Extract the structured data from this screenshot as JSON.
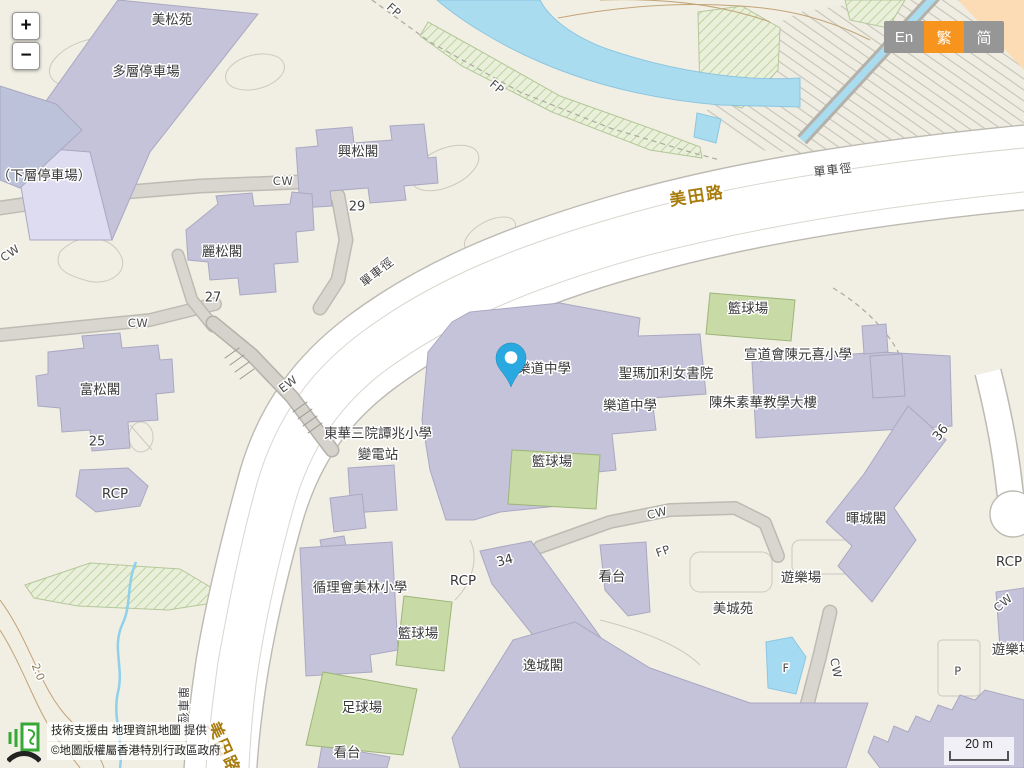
{
  "ui": {
    "zoom_control": {
      "zoom_in": "+",
      "zoom_out": "−"
    },
    "language_switcher": {
      "options": [
        {
          "label": "En",
          "active": false
        },
        {
          "label": "繁",
          "active": true
        },
        {
          "label": "简",
          "active": false
        }
      ]
    },
    "attribution": {
      "logo": "geoinfo-map-logo",
      "support_text": "技術支援由 地理資訊地圖 提供",
      "copyright_text": "©地圖版權屬香港特別行政區政府"
    },
    "scale_bar": "20 m"
  },
  "colors": {
    "background": "#f1efe3",
    "building": "#c5c3d9",
    "building_light": "#dedcf0",
    "road_fill": "#ffffff",
    "road_casing": "#bcbab2",
    "footpath": "#d8d6cf",
    "green_court": "#c8daa6",
    "green_area": "#e9efd9",
    "water": "#aadcf0",
    "contour": "#c2a377",
    "road_label": "#a87d0e",
    "active_lang": "#f7941d",
    "inactive_lang": "#969696",
    "marker": "#2aa9e0",
    "slope_corner": "#fbdcb4"
  },
  "map": {
    "marker": {
      "name": "location-pin",
      "color": "#2aa9e0"
    },
    "labels": [
      {
        "t": "美松苑",
        "x": 172,
        "y": 20,
        "r": 0,
        "c": "b",
        "n": "label-mei-chung-court"
      },
      {
        "t": "多層停車場",
        "x": 146,
        "y": 72,
        "r": 0,
        "c": "b",
        "n": "label-multi-storey-carpark"
      },
      {
        "t": "（下層停車場）",
        "x": 44,
        "y": 176,
        "r": 0,
        "c": "b",
        "n": "label-lower-carpark"
      },
      {
        "t": "興松閣",
        "x": 358,
        "y": 152,
        "r": 0,
        "c": "b",
        "n": "label-hing-chung-house"
      },
      {
        "t": "29",
        "x": 357,
        "y": 207,
        "r": 0,
        "c": "n",
        "n": "label-number-29"
      },
      {
        "t": "麗松閣",
        "x": 222,
        "y": 252,
        "r": 0,
        "c": "b",
        "n": "label-lai-chung-house"
      },
      {
        "t": "27",
        "x": 213,
        "y": 298,
        "r": 0,
        "c": "n",
        "n": "label-number-27"
      },
      {
        "t": "富松閣",
        "x": 100,
        "y": 390,
        "r": 0,
        "c": "b",
        "n": "label-fu-chung-house"
      },
      {
        "t": "25",
        "x": 97,
        "y": 442,
        "r": 0,
        "c": "n",
        "n": "label-number-25"
      },
      {
        "t": "RCP",
        "x": 115,
        "y": 494,
        "r": 0,
        "c": "b",
        "n": "label-rcp-west"
      },
      {
        "t": "CW",
        "x": 283,
        "y": 181,
        "r": 0,
        "c": "p",
        "n": "label-cw-1"
      },
      {
        "t": "CW",
        "x": 138,
        "y": 323,
        "r": 0,
        "c": "p",
        "n": "label-cw-2"
      },
      {
        "t": "CW",
        "x": 10,
        "y": 253,
        "r": -35,
        "c": "p",
        "n": "label-cw-3"
      },
      {
        "t": "EW",
        "x": 288,
        "y": 384,
        "r": -37,
        "c": "p",
        "n": "label-ew"
      },
      {
        "t": "單車徑",
        "x": 377,
        "y": 272,
        "r": -38,
        "c": "cyc",
        "n": "label-cycle-track-1"
      },
      {
        "t": "單車徑",
        "x": 833,
        "y": 170,
        "r": -7,
        "c": "cyc",
        "n": "label-cycle-track-2"
      },
      {
        "t": "單車徑",
        "x": 183,
        "y": 706,
        "r": 90,
        "c": "cyc",
        "n": "label-cycle-track-3"
      },
      {
        "t": "美田路",
        "x": 697,
        "y": 196,
        "r": -9,
        "c": "road",
        "n": "label-mei-tin-road-1"
      },
      {
        "t": "美田路",
        "x": 224,
        "y": 748,
        "r": 66,
        "c": "road",
        "n": "label-mei-tin-road-2"
      },
      {
        "t": "FP",
        "x": 394,
        "y": 10,
        "r": 42,
        "c": "p",
        "n": "label-fp-1"
      },
      {
        "t": "FP",
        "x": 497,
        "y": 87,
        "r": 40,
        "c": "p",
        "n": "label-fp-2"
      },
      {
        "t": "FP",
        "x": 663,
        "y": 551,
        "r": -20,
        "c": "p",
        "n": "label-fp-3"
      },
      {
        "t": "樂道中學",
        "x": 544,
        "y": 369,
        "r": 0,
        "c": "b",
        "n": "label-lok-to-college-1"
      },
      {
        "t": "聖瑪加利女書院",
        "x": 666,
        "y": 374,
        "r": 0,
        "c": "b",
        "n": "label-st-margaret-college"
      },
      {
        "t": "樂道中學",
        "x": 630,
        "y": 406,
        "r": 0,
        "c": "b",
        "n": "label-lok-to-college-2"
      },
      {
        "t": "陳朱素華教學大樓",
        "x": 763,
        "y": 403,
        "r": 0,
        "c": "b",
        "n": "label-chan-chu-so-wah-building"
      },
      {
        "t": "宣道會陳元喜小學",
        "x": 798,
        "y": 355,
        "r": 0,
        "c": "b",
        "n": "label-chan-yuen-hei-primary"
      },
      {
        "t": "籃球場",
        "x": 748,
        "y": 309,
        "r": 0,
        "c": "b",
        "n": "label-basketball-court-1"
      },
      {
        "t": "籃球場",
        "x": 552,
        "y": 462,
        "r": 0,
        "c": "b",
        "n": "label-basketball-court-2"
      },
      {
        "t": "籃球場",
        "x": 418,
        "y": 634,
        "r": 0,
        "c": "b",
        "n": "label-basketball-court-3"
      },
      {
        "t": "足球場",
        "x": 362,
        "y": 708,
        "r": 0,
        "c": "b",
        "n": "label-football-pitch"
      },
      {
        "t": "看台",
        "x": 347,
        "y": 753,
        "r": 0,
        "c": "b",
        "n": "label-stand-1"
      },
      {
        "t": "看台",
        "x": 612,
        "y": 577,
        "r": 0,
        "c": "b",
        "n": "label-stand-2"
      },
      {
        "t": "東華三院譚兆小學",
        "x": 378,
        "y": 434,
        "r": 0,
        "c": "b",
        "n": "label-twgh-tam-shiu-primary"
      },
      {
        "t": "變電站",
        "x": 378,
        "y": 455,
        "r": 0,
        "c": "b",
        "n": "label-substation"
      },
      {
        "t": "循理會美林小學",
        "x": 360,
        "y": 588,
        "r": 0,
        "c": "b",
        "n": "label-fmc-mei-lam-primary"
      },
      {
        "t": "RCP",
        "x": 463,
        "y": 581,
        "r": 0,
        "c": "b",
        "n": "label-rcp-center"
      },
      {
        "t": "34",
        "x": 505,
        "y": 561,
        "r": -15,
        "c": "n",
        "n": "label-number-34"
      },
      {
        "t": "逸城閣",
        "x": 543,
        "y": 666,
        "r": 0,
        "c": "b",
        "n": "label-yat-shing-house"
      },
      {
        "t": "美城苑",
        "x": 733,
        "y": 609,
        "r": 0,
        "c": "b",
        "n": "label-mei-shing-court"
      },
      {
        "t": "遊樂場",
        "x": 801,
        "y": 578,
        "r": 0,
        "c": "b",
        "n": "label-playground-1"
      },
      {
        "t": "暉城閣",
        "x": 866,
        "y": 519,
        "r": 0,
        "c": "b",
        "n": "label-fai-shing-house"
      },
      {
        "t": "36",
        "x": 941,
        "y": 433,
        "r": -52,
        "c": "n",
        "n": "label-number-36"
      },
      {
        "t": "RCP",
        "x": 1009,
        "y": 562,
        "r": 0,
        "c": "b",
        "n": "label-rcp-east"
      },
      {
        "t": "CW",
        "x": 1003,
        "y": 603,
        "r": -40,
        "c": "p",
        "n": "label-cw-4"
      },
      {
        "t": "遊樂場",
        "x": 1012,
        "y": 650,
        "r": 0,
        "c": "b",
        "n": "label-playground-2"
      },
      {
        "t": "P",
        "x": 958,
        "y": 671,
        "r": 0,
        "c": "p",
        "n": "label-p"
      },
      {
        "t": "F",
        "x": 786,
        "y": 668,
        "r": 0,
        "c": "p",
        "n": "label-f-pool"
      },
      {
        "t": "CW",
        "x": 657,
        "y": 513,
        "r": -13,
        "c": "p",
        "n": "label-cw-5"
      },
      {
        "t": "CW",
        "x": 836,
        "y": 668,
        "r": 78,
        "c": "p",
        "n": "label-cw-6"
      },
      {
        "t": "2.0",
        "x": 38,
        "y": 672,
        "r": 68,
        "c": "brown",
        "n": "label-contour-2-0"
      }
    ]
  }
}
